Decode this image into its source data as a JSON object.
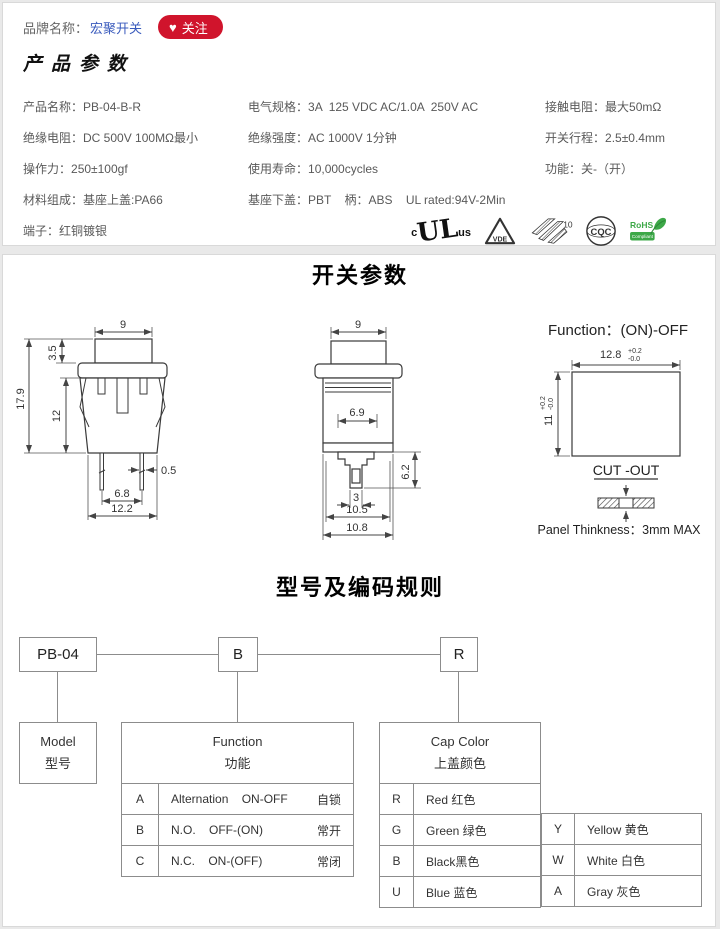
{
  "header": {
    "brand_label": "品牌名称：",
    "brand_name": "宏聚开关",
    "follow_icon": "♥",
    "follow_label": "关注",
    "link_color": "#3a5bbd",
    "follow_bg": "#d0142c"
  },
  "product_params": {
    "title": "产品参数",
    "rows": [
      {
        "c1l": "产品名称：",
        "c1v": "PB-04-B-R",
        "c2l": "电气规格：",
        "c2v": "3A  125 VDC AC/1.0A  250V AC",
        "c3l": "接触电阻：",
        "c3v": "最大50mΩ"
      },
      {
        "c1l": "绝缘电阻：",
        "c1v": "DC 500V 100MΩ最小",
        "c2l": "绝缘强度：",
        "c2v": "AC 1000V 1分钟",
        "c3l": "开关行程：",
        "c3v": "2.5±0.4mm"
      },
      {
        "c1l": "操作力：",
        "c1v": "250±100gf",
        "c2l": "使用寿命：",
        "c2v": "10,000cycles",
        "c3l": "功能：",
        "c3v": "关-（开）"
      },
      {
        "c1l": "材料组成：",
        "c1v": "基座上盖:PA66",
        "c2l": "基座下盖：",
        "c2v": "PBT    柄：ABS    UL rated:94V-2Min",
        "c3l": "",
        "c3v": ""
      },
      {
        "c1l": "端子：",
        "c1v": "红铜镀银",
        "c2l": "",
        "c2v": "",
        "c3l": "",
        "c3v": ""
      }
    ]
  },
  "certs": {
    "ul_c": "c",
    "ul_mark": "UL",
    "ul_us": "us",
    "vde": "VDE",
    "ek_num": "10",
    "cqc": "CQC",
    "rohs_title": "RoHS",
    "rohs_sub": "Compliant",
    "rohs_green": "#3da848"
  },
  "switch_params": {
    "title": "开关参数",
    "front": {
      "w_top": "9",
      "cap_h": "3.5",
      "total_h": "17.9",
      "body_h": "12",
      "pin_w": "0.5",
      "pin_pitch": "6.8",
      "body_w": "12.2"
    },
    "side": {
      "w_top": "9",
      "inner_w": "6.9",
      "lower_h": "6.2",
      "pin_w": "3",
      "w1": "10.5",
      "w2": "10.8"
    },
    "cutout": {
      "function_label": "Function：(ON)-OFF",
      "width": "12.8",
      "tol_up": "+0.2",
      "tol_dn": "-0.0",
      "height": "11",
      "label": "CUT -OUT",
      "panel_note": "Panel Thinkness：3mm MAX"
    }
  },
  "coding": {
    "title": "型号及编码规则",
    "code_boxes": [
      "PB-04",
      "B",
      "R"
    ],
    "model_box": {
      "en": "Model",
      "zh": "型号"
    },
    "function_table": {
      "header_en": "Function",
      "header_zh": "功能",
      "rows": [
        {
          "code": "A",
          "desc": "Alternation    ON-OFF",
          "zh": "自锁"
        },
        {
          "code": "B",
          "desc": "N.O.    OFF-(ON)",
          "zh": "常开"
        },
        {
          "code": "C",
          "desc": "N.C.    ON-(OFF)",
          "zh": "常闭"
        }
      ]
    },
    "cap_color_table": {
      "header_en": "Cap Color",
      "header_zh": "上盖颜色",
      "left_rows": [
        {
          "code": "R",
          "label": "Red 红色"
        },
        {
          "code": "G",
          "label": "Green 绿色"
        },
        {
          "code": "B",
          "label": "Black黑色"
        },
        {
          "code": "U",
          "label": "Blue 蓝色"
        }
      ],
      "right_rows": [
        {
          "code": "Y",
          "label": "Yellow 黄色"
        },
        {
          "code": "W",
          "label": "White 白色"
        },
        {
          "code": "A",
          "label": "Gray 灰色"
        }
      ]
    }
  }
}
